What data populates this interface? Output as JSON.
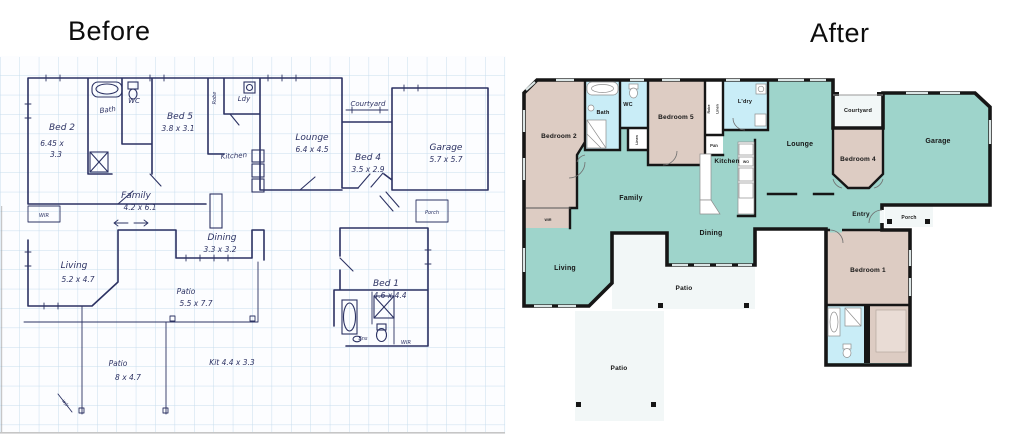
{
  "titles": {
    "before": "Before",
    "after": "After"
  },
  "colors": {
    "teal": "#9ed4cb",
    "tan": "#ddccc3",
    "wet": "#c9edf7",
    "outdoor": "#f2f7f7",
    "wall": "#161616",
    "ink": "#2c3263",
    "grid": "#c7ddee"
  },
  "before": {
    "rooms": [
      {
        "label": "Bed 2",
        "dims": "6.45 x",
        "dims2": "3.3"
      },
      {
        "label": "Bath"
      },
      {
        "label": "WC"
      },
      {
        "label": "Bed 5",
        "dims": "3.8 x 3.1"
      },
      {
        "label": "Robe"
      },
      {
        "label": "Ldy"
      },
      {
        "label": "Lounge",
        "dims": "6.4 x 4.5"
      },
      {
        "label": "Courtyard"
      },
      {
        "label": "Bed 4",
        "dims": "3.5 x 2.9"
      },
      {
        "label": "Garage",
        "dims": "5.7 x 5.7"
      },
      {
        "label": "Family",
        "dims": "4.2 x 6.1"
      },
      {
        "label": "Kitchen"
      },
      {
        "label": "Dining",
        "dims": "3.3 x 3.2"
      },
      {
        "label": "Living",
        "dims": "5.2 x 4.7"
      },
      {
        "label": "Patio",
        "dims": "5.5 x 7.7"
      },
      {
        "label": "Bed 1",
        "dims": "4.6 x 4.4"
      },
      {
        "label": "Ens"
      },
      {
        "label": "WIR"
      },
      {
        "label": "Patio",
        "dims": "8 x 4.7"
      },
      {
        "label": "Kit 4.4 x 3.3"
      },
      {
        "label": "WIR"
      },
      {
        "label": "Porch"
      },
      {
        "label": "w/r"
      }
    ]
  },
  "after": {
    "rooms": [
      {
        "label": "Bedroom 2"
      },
      {
        "label": "Bath"
      },
      {
        "label": "WC"
      },
      {
        "label": "Linen"
      },
      {
        "label": "Bedroom 5"
      },
      {
        "label": "Robe"
      },
      {
        "label": "Linen"
      },
      {
        "label": "L'dry"
      },
      {
        "label": "Pan"
      },
      {
        "label": "Lounge"
      },
      {
        "label": "Courtyard"
      },
      {
        "label": "Bedroom 4"
      },
      {
        "label": "Garage"
      },
      {
        "label": "Kitchen"
      },
      {
        "label": "WO"
      },
      {
        "label": "Family"
      },
      {
        "label": "WIR"
      },
      {
        "label": "Dining"
      },
      {
        "label": "Entry"
      },
      {
        "label": "Porch"
      },
      {
        "label": "Living"
      },
      {
        "label": "Patio"
      },
      {
        "label": "Patio"
      },
      {
        "label": "Bedroom 1"
      }
    ]
  }
}
